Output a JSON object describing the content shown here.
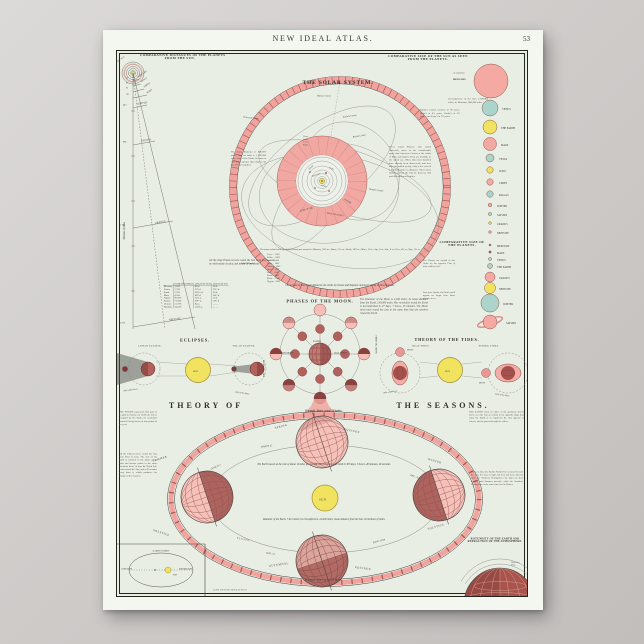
{
  "page": {
    "atlas_title": "NEW IDEAL ATLAS.",
    "page_number": "53",
    "imprint": "COPR. BY RAND, McNALLY & CO."
  },
  "colors": {
    "pink": "#f0a49d",
    "light_pink": "#f6c1b9",
    "maroon": "#9c4b48",
    "yellow": "#f1e35f",
    "teal": "#abd4ca",
    "paper": "#f4f6f0",
    "map_bg": "#e9eee5"
  },
  "distances": {
    "title1": "COMPARATIVE DISTANCES OF THE PLANETS",
    "title2": "FROM THE SUN.",
    "sun_label": "THE SUN",
    "axis_label": "Millions of Miles",
    "inner": [
      {
        "name": "MERCURY",
        "value": "36"
      },
      {
        "name": "VENUS",
        "value": "67"
      },
      {
        "name": "EARTH",
        "value": "93"
      },
      {
        "name": "MARS",
        "value": "141"
      }
    ],
    "arcs": [
      {
        "name": "JUPITER",
        "value": "483"
      },
      {
        "name": "SATURN",
        "value": "886"
      },
      {
        "name": "URANUS",
        "value": "1,782"
      },
      {
        "name": "NEPTUNE",
        "value": "2,793"
      }
    ],
    "note": "All the large Planets revolve round the Sun from west to east, in orbits nearly circular, and nearly in one plane."
  },
  "planet_table": {
    "col0": "",
    "col1": "Diameter in Miles",
    "col2": "Length of Year",
    "col3": "Length of Day",
    "rows": [
      [
        "Mercury",
        "3,000",
        "88 d.",
        "24 h."
      ],
      [
        "Venus",
        "7,700",
        "225 d.",
        "23½ h."
      ],
      [
        "Earth",
        "7,912",
        "365¼ d.",
        "24 h."
      ],
      [
        "Mars",
        "4,200",
        "687 d.",
        "24½ h."
      ],
      [
        "Jupiter",
        "85,000",
        "11⅞ y.",
        "10 h."
      ],
      [
        "Saturn",
        "71,000",
        "29½ y.",
        "10½ h."
      ],
      [
        "Uranus",
        "31,700",
        "84 y.",
        "— —"
      ],
      [
        "Neptune",
        "34,500",
        "164⅝ y.",
        "— —"
      ]
    ]
  },
  "solar_system": {
    "title": "THE SOLAR SYSTEM.",
    "halley": "Halley's Comet",
    "encke": "Encke's Comet",
    "darrest": "D'Arrest's Comet",
    "biela": "Biela's Comet",
    "donati": "Donati's Comet",
    "halley_note": "Halley's Comet revolves in 76 years, Biela's in 6¾ years, Encke's in 3⅓ years, and Faye's in 7½ years.",
    "left_note": "The Sun's diameter is 860,000 miles, and its bulk is 1,300,000 times that of the Earth; its mass is 700 times greater than that of all the Planets together.",
    "right_note": "These small Planets, also called Asteroids, move in the considerable space that intervenes between the orbits of Mars and Jupiter. They are invisible to the naked eye. More than four hundred have already been discovered, and new ones are added yearly; only a few exceed a hundred miles in diameter. Their mean distances from the Sun lie between 200 and 400 millions of miles.",
    "zone1": "ZONE OF THE",
    "zone2": "SMALL PLANETS",
    "jupiter_orbit": "JUPITER",
    "ring_names": "Vesta\nJuno\nCeres\nPallas",
    "orbit_names": [
      "MERCURY",
      "VENUS",
      "EARTH",
      "MARS"
    ],
    "velocity_note": "The mean orbital velocity of the Planets per second is: Mercury, 29½ m.; Venus, 21¾ m.; Earth, 18½ m.; Mars, 15 m.; Jup., 8 m.; Sat., 6 m.; Ura., 4¼ m.; Nep., 3⅓ m.",
    "small_planets_label": "Small Planets",
    "small_planets": "Ceres . . 1801\nPallas . . 1802\nJuno . . 1804\nVesta . . 1807\nAstraea . 1845\nHebe . . 1847\nIris . . . 1847\nFlora . . 1847\nMetis . . 1848\nHygeia . 1849",
    "outer_note": "On account of their great distances, the orbits of Uranus and Neptune cannot be shown on this Diagram."
  },
  "sun_size": {
    "title1": "COMPARATIVE SIZE OF THE SUN AS SEEN",
    "title2": "FROM THE PLANETS.",
    "as_seen_from": "As seen from",
    "mercury": "MERCURY",
    "note": "Circumference of the Sun, 2,700,000 miles; its Diameter, 860,000 miles.",
    "items": [
      "VENUS",
      "THE EARTH",
      "MARS",
      "VESTA",
      "JUNO",
      "CERES",
      "PALLAS",
      "JUPITER",
      "SATURN",
      "URANUS",
      "NEPTUNE"
    ]
  },
  "planet_size": {
    "title1": "COMPARATIVE SIZE OF",
    "title2": "THE PLANETS.",
    "note1": "The Planets are ranked in this Order by the opposite Plan of their relative sizes.",
    "note2": "Seen from Jupiter, the Earth would appear no larger than Venus appears to us.",
    "items": [
      "MERCURY",
      "MARS",
      "VENUS",
      "THE EARTH",
      "URANUS",
      "NEPTUNE",
      "JUPITER",
      "SATURN"
    ]
  },
  "phases": {
    "title": "PHASES OF THE MOON.",
    "note": "The Diameter of the Moon is 2,160 miles; its mean distance from the Earth, 240,000 miles. Her revolution round the Earth is accomplished in 27 days, 7 hours, 43 minutes. The Moon turns once round her axis in the same time that she revolves round the Earth.",
    "earth": "EARTH",
    "new_moon": "NEW MOON",
    "full_moon": "FULL MOON",
    "first_quarter": "FIRST QUARTER",
    "third_quarter": "THIRD QUARTER"
  },
  "eclipses": {
    "title": "ECLIPSES.",
    "lunar": "LUNAR ECLIPSE.",
    "solar": "SOLAR ECLIPSE.",
    "sun": "SUN",
    "orbit_caption1": "Orbit of the Moon",
    "orbit_caption2": "Orbit of the Moon"
  },
  "tides": {
    "title": "THEORY OF THE TIDES.",
    "neap": "NEAP TIDES.",
    "spring": "SPRING TIDES.",
    "sun": "SUN",
    "moon1": "MOON",
    "moon2": "MOON",
    "orbit_caption1": "Orbit of the Moon",
    "orbit_caption2": "Orbit of the Moon"
  },
  "seasons": {
    "title_left": "THEORY OF",
    "title_right": "THE SEASONS.",
    "equal_top": "Equal Day and Night.",
    "equal_bottom": "Equal Day and Night.",
    "sun": "SUN",
    "spring": "SPRING",
    "spring_equinox": "EQUINOX",
    "march": "MARCH 21.",
    "summer": "SUMMER",
    "summer_solstice": "SOLSTICE",
    "june": "(JUNE 21.)",
    "winter": "WINTER",
    "winter_solstice": "SOLSTICE",
    "dec": "(DEC. 22.)",
    "autumn": "AUTUMNAL",
    "autumn_equinox": "EQUINOX",
    "sept": "SEPT. 23.",
    "ecliptic": "ECLIPTIC",
    "earths_orbit": "Earth's Orbit",
    "center_note1": "The Earth travels at the rate of about 19 miles per second, and revolves in its orbit in 365 days, 5 hours, 48 minutes, 46 seconds.",
    "center_note2": "Diameter of the Earth, 7,912 miles; its circumference, 24,900 miles; mean distance from the Sun, 92 millions of miles.",
    "left_note1": "THE FIGURE represents that part of its path in Summer in which the Sun is occupied by the Earth, its revolution around it being shown at four points of the year.",
    "left_note2": "All the Planets move round the Sun from West to East. The axis of the Earth is inclined to the plane of its orbit and always points in the same direction; hence in June the North Pole leans toward the Sun, and in December away from it, which produces the change of the Seasons.",
    "right_note1": "THE EARTH when in either of the positions shown above sees the Sun as exactly in the opposite Sign; thus when the Earth is in Capricorn the Sun appears in Cancer, and so passes through the others.",
    "right_note2": "When in June the Earth's North Pole is turned toward the Sun, the rays of light and heat fall more directly upon the Northern Hemisphere; the days are then longest, and Summer prevails, while the Southern Hemisphere at the same time has its Winter."
  },
  "rotundity": {
    "title1": "ROTUNDITY OF THE EARTH AND",
    "title2": "REFRACTION OF THE ATMOSPHERE.",
    "label": "Observer's\nPlace"
  },
  "orbit_inset": {
    "title": "EARTH'S ORBIT",
    "aphelion": "APHELION",
    "perihelion": "PERIHELION",
    "sun": "SUN"
  }
}
